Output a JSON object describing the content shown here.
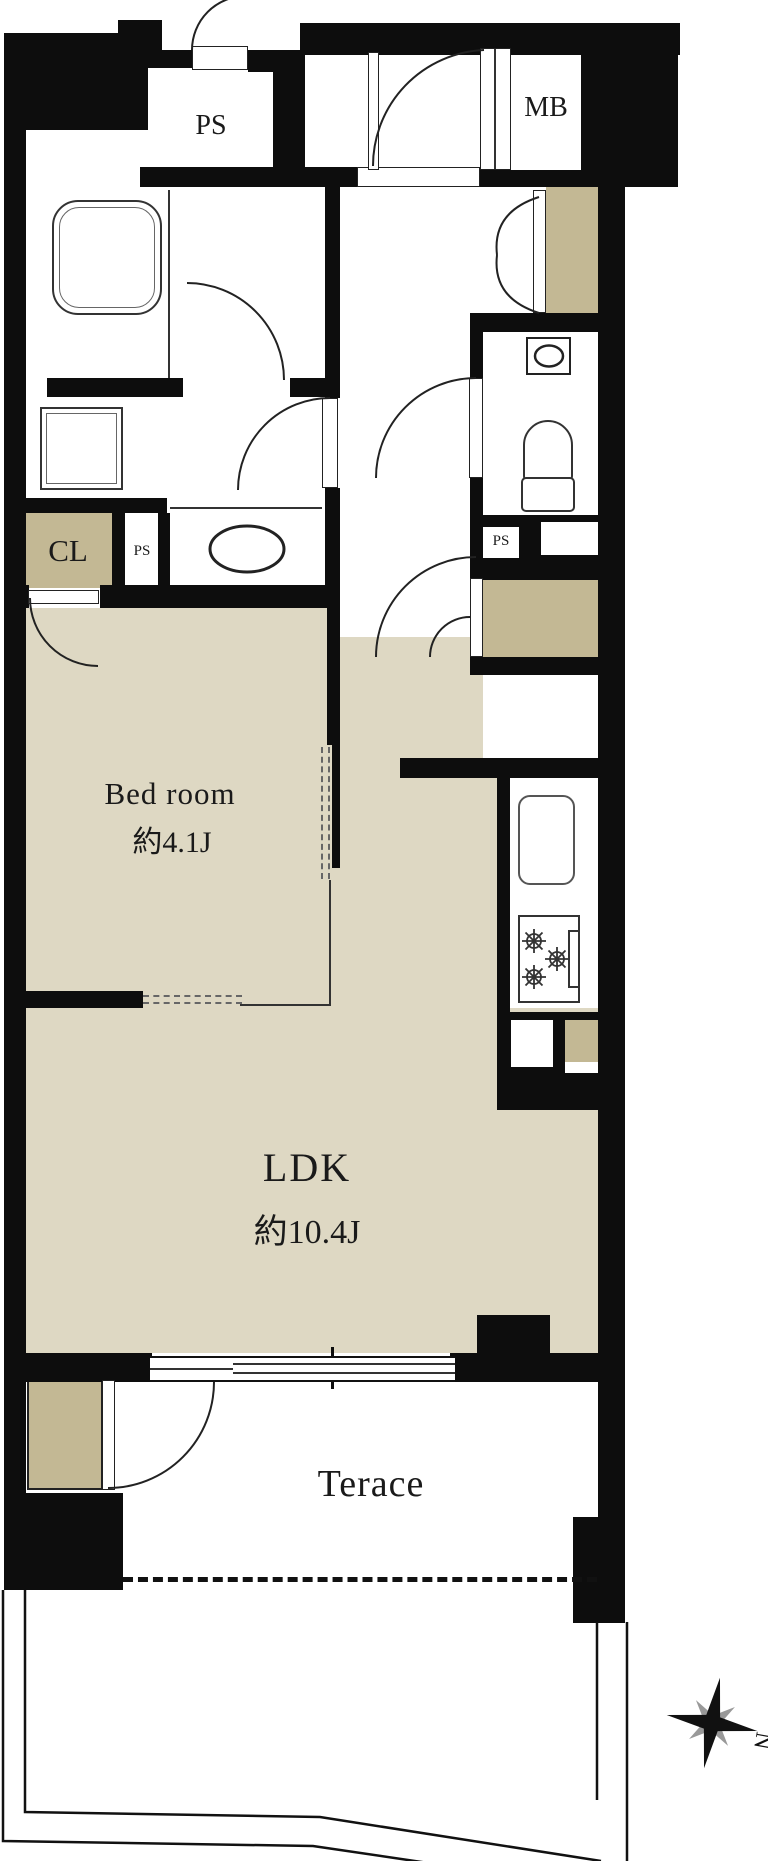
{
  "plan": {
    "type": "floor-plan",
    "rooms": {
      "bedroom": {
        "name": "Bed room",
        "area": "約4.1J"
      },
      "ldk": {
        "name": "LDK",
        "area": "約10.4J"
      },
      "terrace": {
        "name": "Terace"
      }
    },
    "compartments": {
      "pipe_space_top": "PS",
      "meter_box": "MB",
      "closet": "CL",
      "pipe_space_washroom": "PS",
      "pipe_space_toilet": "PS"
    },
    "compass": {
      "north_label": "N"
    },
    "colors": {
      "floor": "#ded8c3",
      "storage": "#c3b894",
      "wall": "#0d0d0d",
      "line": "#222222",
      "bg": "#ffffff"
    }
  }
}
